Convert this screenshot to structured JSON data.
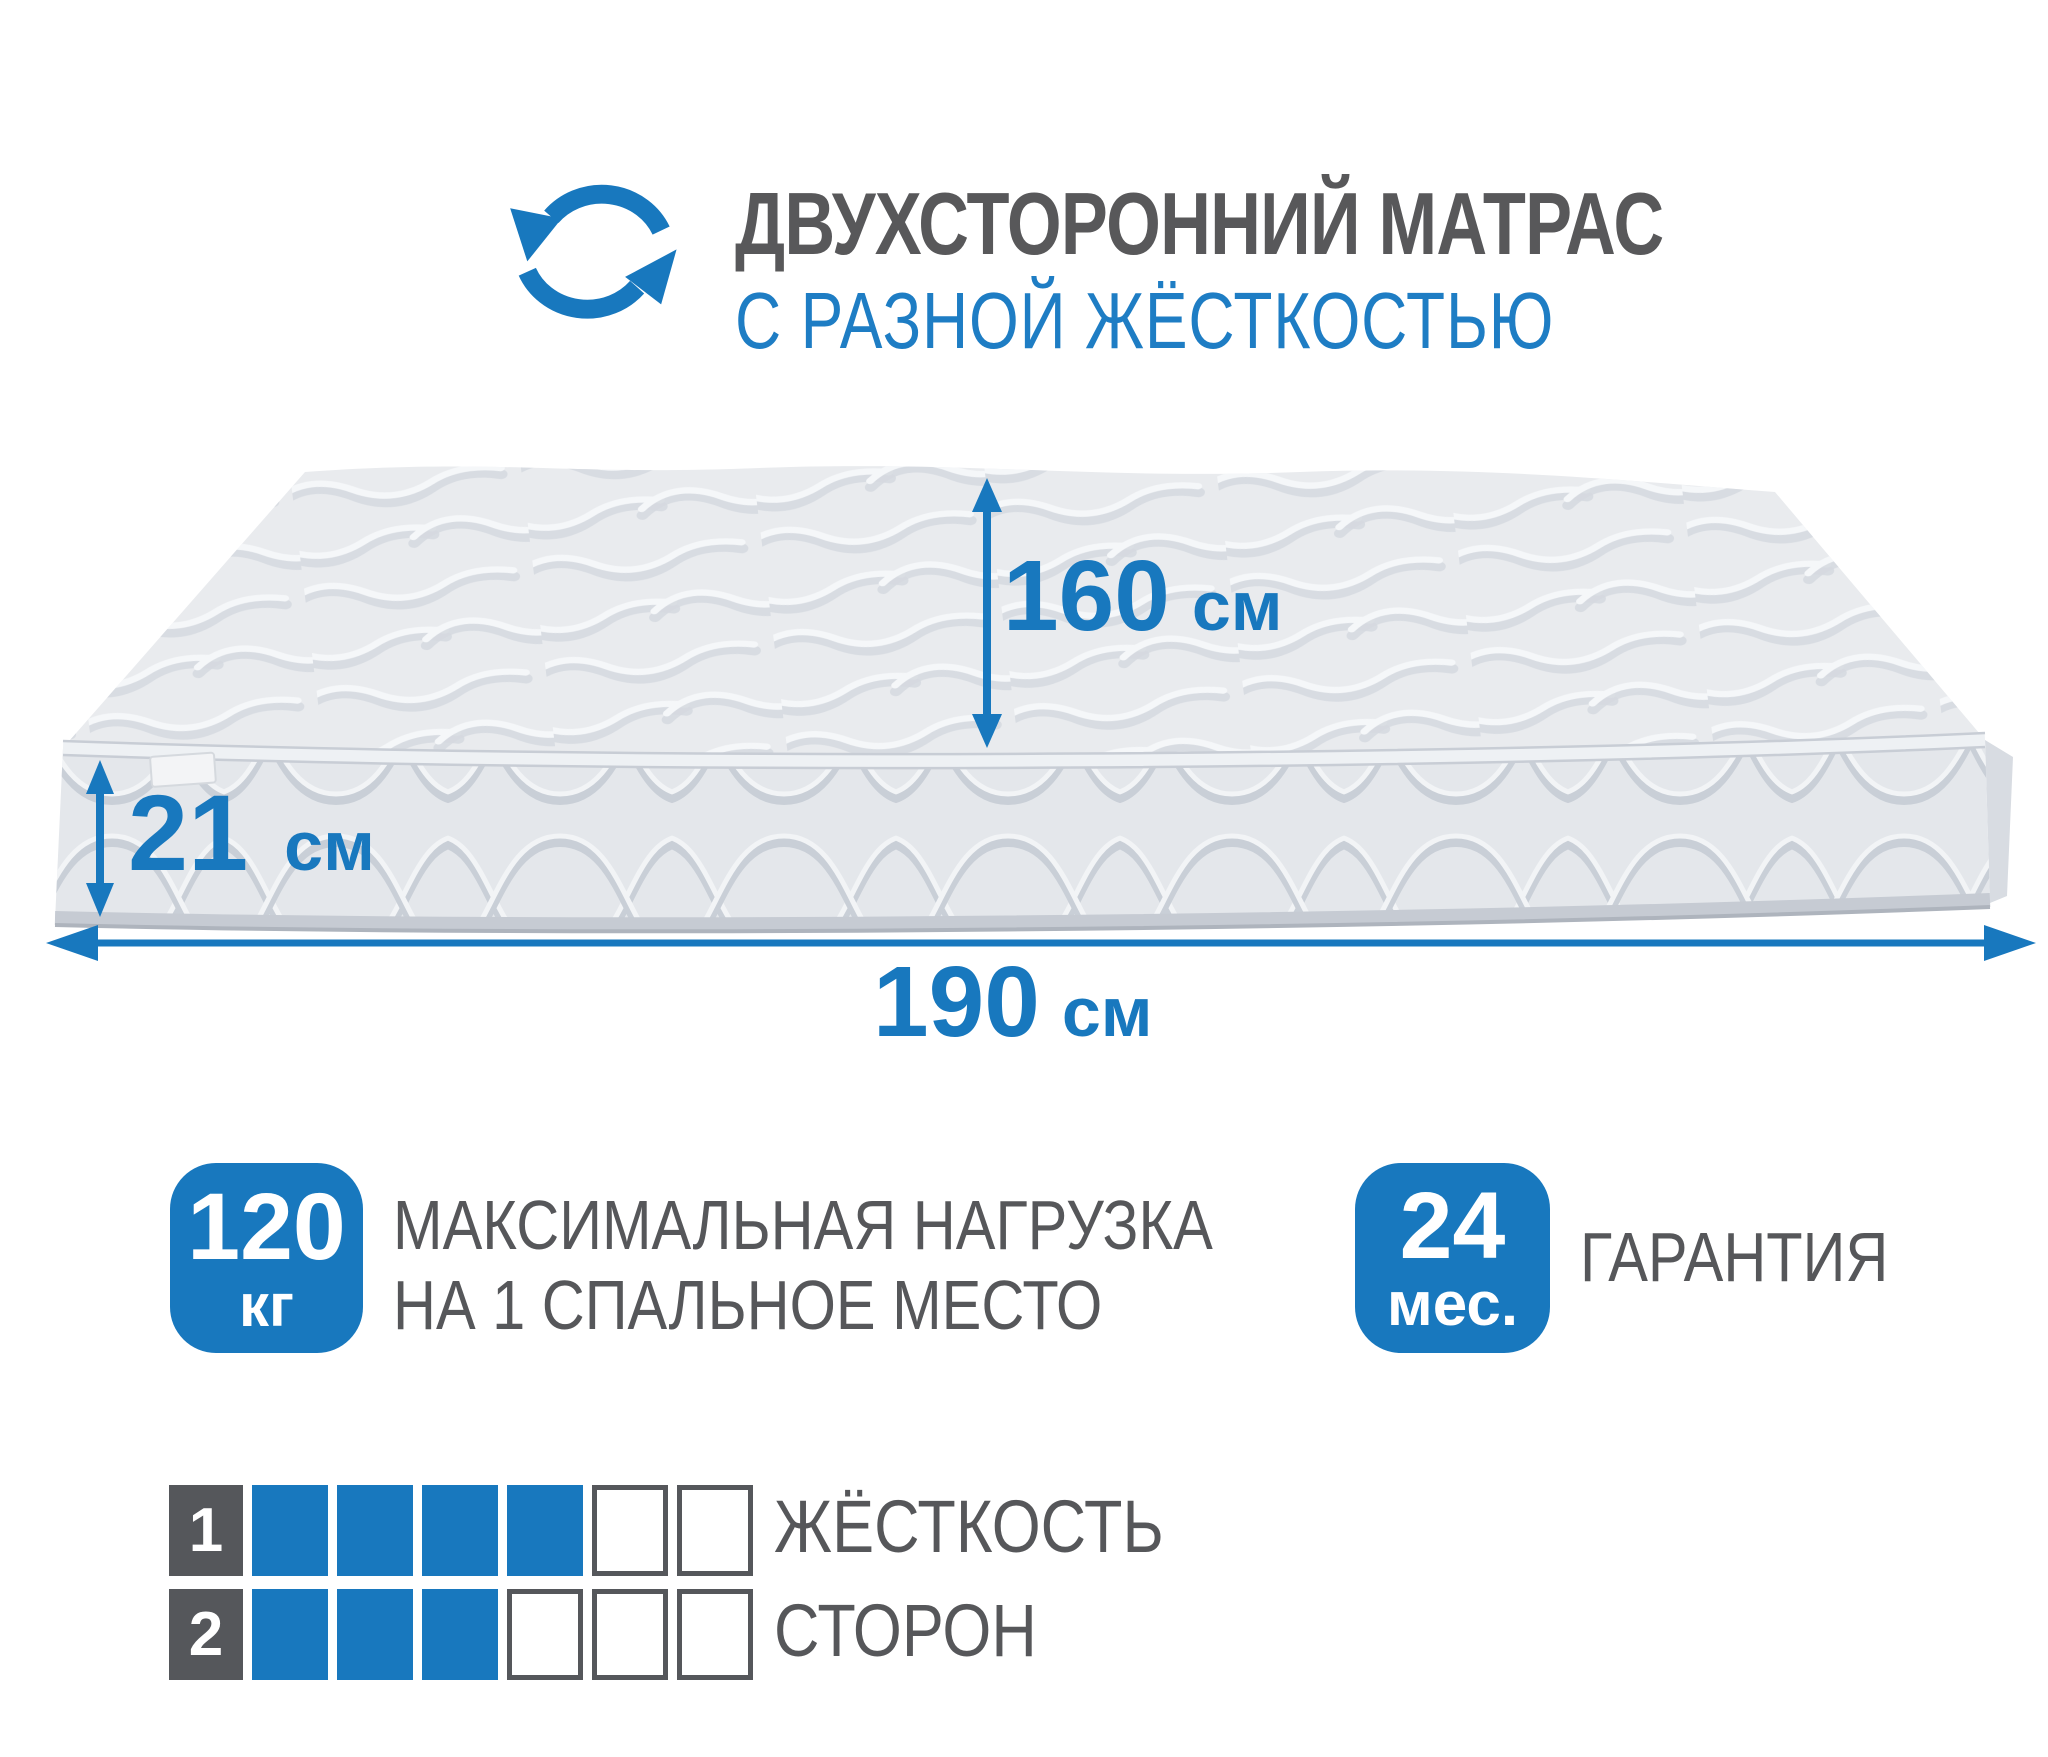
{
  "colors": {
    "accent": "#1878be",
    "title_blue": "#1e7dc4",
    "dark_gray": "#58585a",
    "caption_gray": "#56575a",
    "square_outline": "#55575b",
    "mattress_top": "#e9ebee",
    "mattress_front": "#e4e7eb",
    "mattress_side": "#d8dce2"
  },
  "header": {
    "title_line1": "ДВУХСТОРОННИЙ МАТРАС",
    "title_line2": "С РАЗНОЙ ЖЁСТКОСТЬЮ",
    "icon": "rotate-arrows-icon"
  },
  "dimensions": {
    "width": {
      "value": "160",
      "unit": "см"
    },
    "height": {
      "value": "21",
      "unit": "см"
    },
    "length": {
      "value": "190",
      "unit": "см"
    }
  },
  "badges": {
    "max_load": {
      "value": "120",
      "unit": "кг",
      "caption_line1": "МАКСИМАЛЬНАЯ НАГРУЗКА",
      "caption_line2": "НА 1 СПАЛЬНОЕ МЕСТО"
    },
    "warranty": {
      "value": "24",
      "unit": "мес.",
      "caption": "ГАРАНТИЯ"
    }
  },
  "firmness": {
    "caption_line1": "ЖЁСТКОСТЬ",
    "caption_line2": "СТОРОН",
    "rows": [
      {
        "label": "1",
        "filled": 4,
        "total": 6
      },
      {
        "label": "2",
        "filled": 3,
        "total": 6
      }
    ]
  }
}
